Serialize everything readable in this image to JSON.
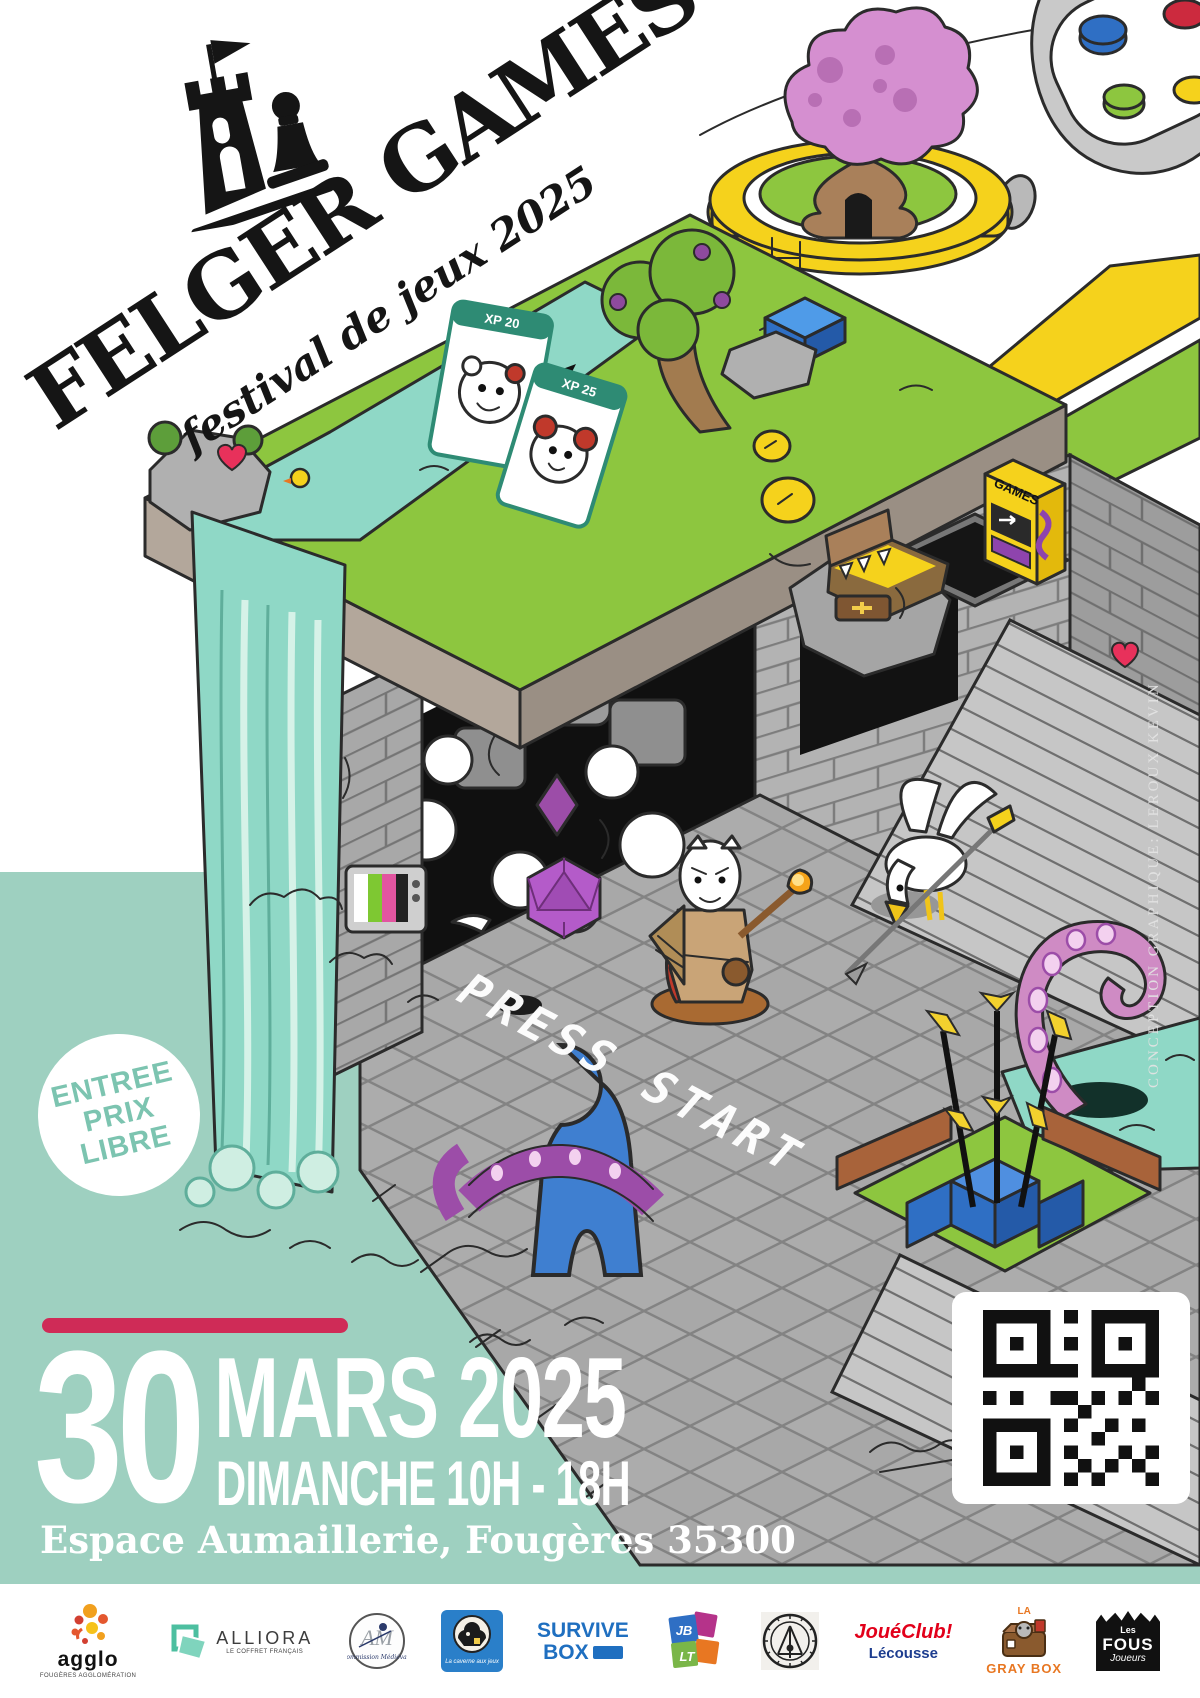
{
  "poster": {
    "title": "FELGER GAMES",
    "subtitle": "festival de jeux 2025",
    "badge": [
      "ENTREE",
      "PRIX",
      "LIBRE"
    ],
    "floor_text": "PRESS START",
    "arcade_text": "GAMES",
    "cards": [
      "XP 20",
      "XP 25"
    ],
    "credit": "CONCEPTION GRAPHIQUE: LEROUX KEVIN",
    "date_day": "30",
    "date_month_year": "MARS 2025",
    "date_time": "DIMANCHE 10H - 18H",
    "venue": "Espace Aumaillerie, Fougères 35300"
  },
  "colors": {
    "teal": "#9ed0c0",
    "water": "#8fd8c6",
    "water_light": "#d6f2e8",
    "grass": "#8dc63f",
    "grass_dark": "#6ea52d",
    "stone": "#b3b3b3",
    "stone_dark": "#8b8b8b",
    "soil": "#b3a79b",
    "accent": "#cf2b57",
    "yellow": "#f5d21c",
    "purple": "#9c4da8",
    "pink": "#cf8bc4",
    "tree_pink": "#d58fd0",
    "blue": "#3f7fd0",
    "brown": "#a9805a",
    "badge_text": "#7cc4b0"
  },
  "sponsors": [
    {
      "name": "agglo",
      "line1": "agglo",
      "line2": "FOUGÈRES AGGLOMÉRATION"
    },
    {
      "name": "alliora",
      "line1": "ALLIORA",
      "line2": "LE COFFRET FRANÇAIS"
    },
    {
      "name": "commission-medievale",
      "line1": "AM",
      "line2": "Commission Médiévale"
    },
    {
      "name": "caverne-aux-jeux",
      "line1": "La caverne aux jeux"
    },
    {
      "name": "survive-box",
      "line1": "SURVIVE",
      "line2": "BOX"
    },
    {
      "name": "jblt",
      "line1": "JB",
      "line2": "LT"
    },
    {
      "name": "seal-emblem"
    },
    {
      "name": "joueclub",
      "line1": "JouéClub!",
      "line2": "Lécousse"
    },
    {
      "name": "gray-box",
      "line1": "LA",
      "line2": "GRAY BOX"
    },
    {
      "name": "fous-joueurs",
      "line1": "Les",
      "line2": "FOUS",
      "line3": "Joueurs"
    }
  ]
}
